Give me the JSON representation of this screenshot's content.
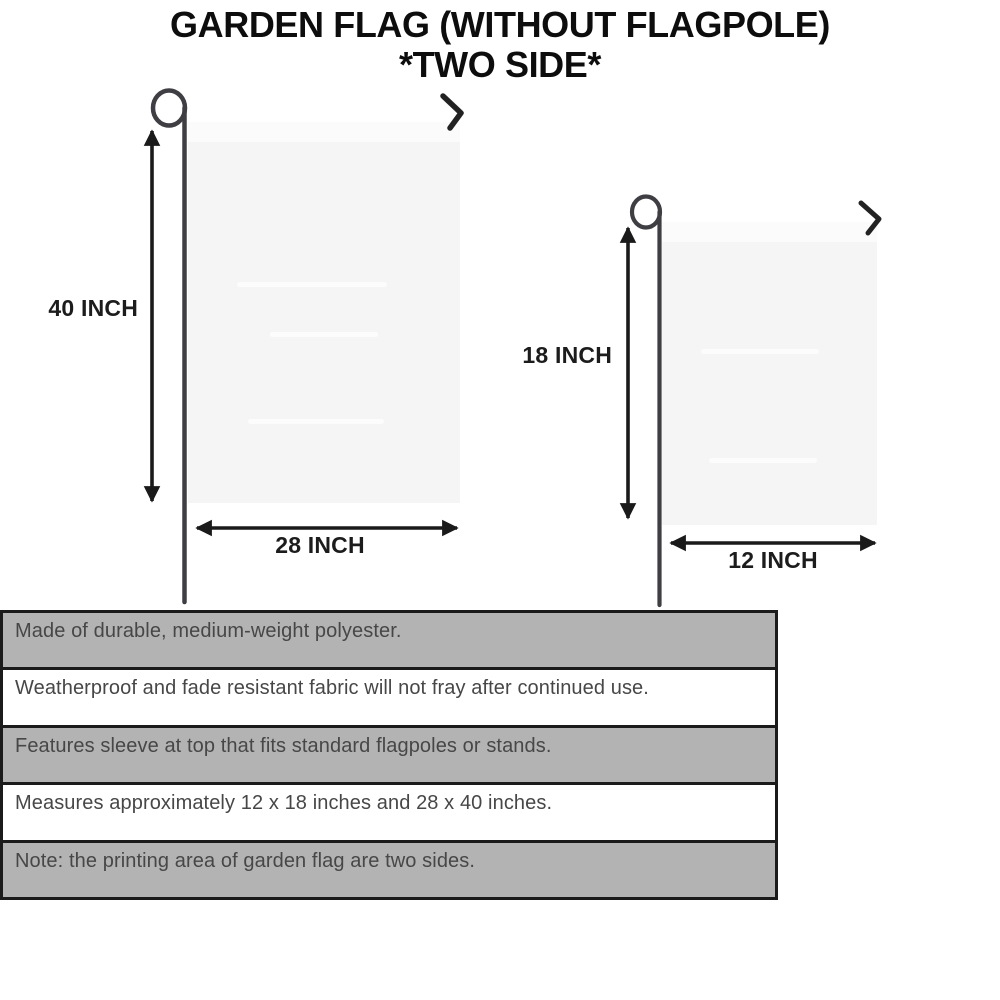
{
  "title": {
    "line1": "GARDEN FLAG (WITHOUT FLAGPOLE)",
    "line2": "*TWO SIDE*"
  },
  "diagram": {
    "large_flag": {
      "height_label": "40 INCH",
      "width_label": "28 INCH"
    },
    "small_flag": {
      "height_label": "18 INCH",
      "width_label": "12 INCH"
    }
  },
  "specs": {
    "rows": [
      {
        "text": "Made of durable, medium-weight polyester."
      },
      {
        "text": "Weatherproof and fade resistant fabric will not fray after continued use."
      },
      {
        "text": "Features sleeve at top that fits standard flagpoles or stands."
      },
      {
        "text": "Measures approximately 12 x 18 inches and 28 x 40 inches."
      },
      {
        "text": "Note: the printing area of garden flag are two sides."
      }
    ]
  },
  "colors": {
    "background": "#ffffff",
    "title_text": "#0d0d0d",
    "flag_fill": "#f5f5f6",
    "pole": "#3e3e43",
    "hook": "#222222",
    "arrow": "#1a1a1a",
    "table_border": "#1b1b1b",
    "row_shaded": "#b3b3b3",
    "row_plain": "#ffffff",
    "row_text": "#474747"
  }
}
